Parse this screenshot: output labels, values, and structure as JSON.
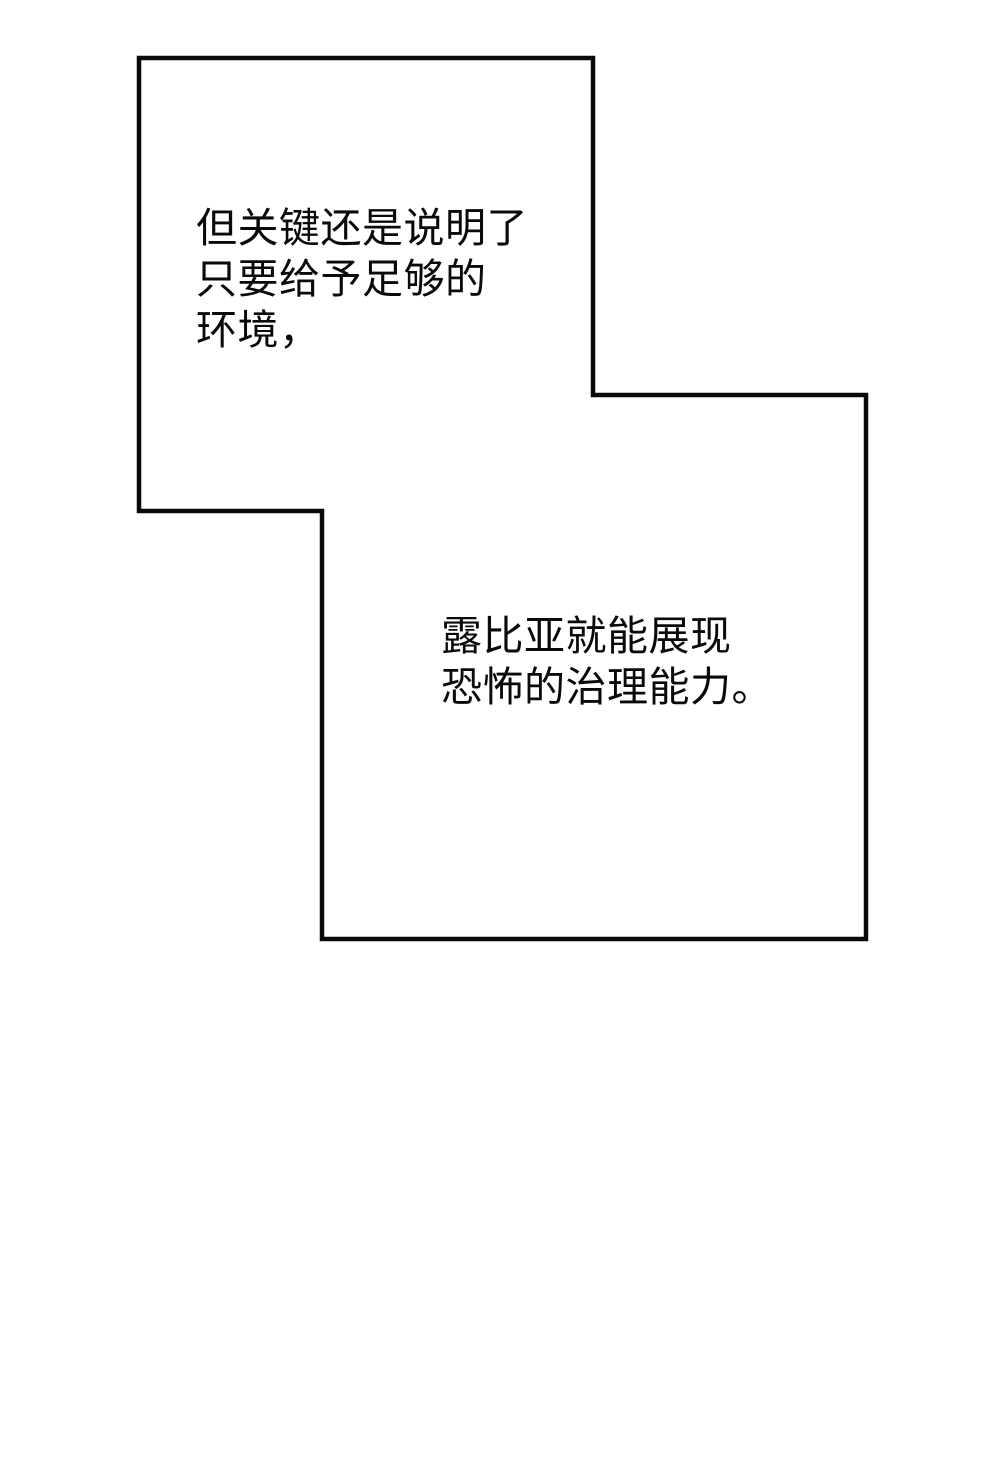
{
  "page": {
    "background_color": "#ffffff",
    "panel_border_color": "#0a0a0a",
    "text_color": "#0a0a0a"
  },
  "panels": [
    {
      "id": "panel-top-left",
      "text_lines": [
        "但关键还是说明了",
        "只要给予足够的",
        "环境，"
      ]
    },
    {
      "id": "panel-bottom-right",
      "text_lines": [
        "露比亚就能展现",
        "恐怖的治理能力。"
      ]
    }
  ]
}
